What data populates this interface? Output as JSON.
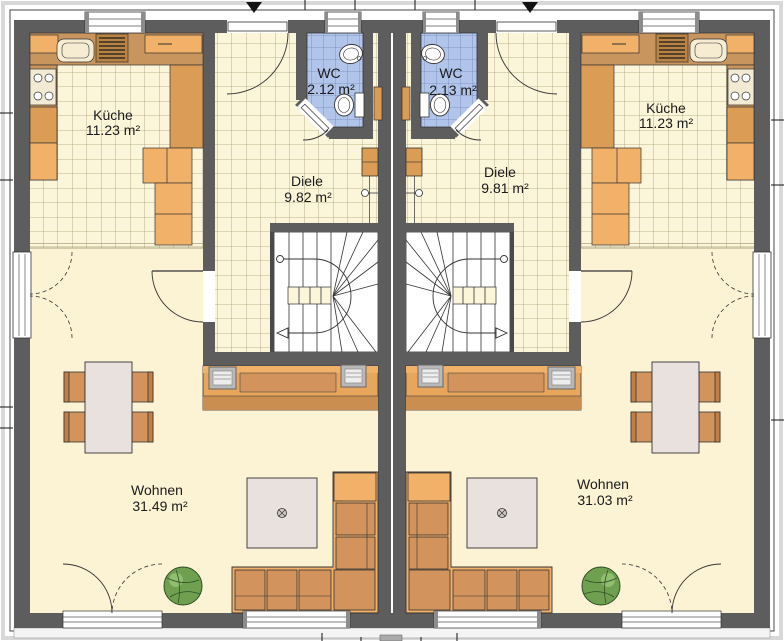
{
  "units": {
    "left": {
      "kueche": {
        "name": "Küche",
        "area": "11.23 m²"
      },
      "wc": {
        "name": "WC",
        "area": "2.12 m²"
      },
      "diele": {
        "name": "Diele",
        "area": "9.82 m²"
      },
      "wohnen": {
        "name": "Wohnen",
        "area": "31.49 m²"
      }
    },
    "right": {
      "kueche": {
        "name": "Küche",
        "area": "11.23 m²"
      },
      "wc": {
        "name": "WC",
        "area": "2.13 m²"
      },
      "diele": {
        "name": "Diele",
        "area": "9.81 m²"
      },
      "wohnen": {
        "name": "Wohnen",
        "area": "31.03 m²"
      }
    }
  },
  "colors": {
    "wall": "#5d5d5d",
    "tile_floor": "#fbf5da",
    "tile_line": "#a9a075",
    "living_floor": "#fcf2d4",
    "wc_tile": "#b1c5eb",
    "counter_tan": "#c9955e",
    "cabinet_light": "#f2b168",
    "cabinet_mid": "#db9c55",
    "upholstery": "#d2945c",
    "table_top": "#e9e1dd",
    "plant_green": "#6fa050"
  }
}
